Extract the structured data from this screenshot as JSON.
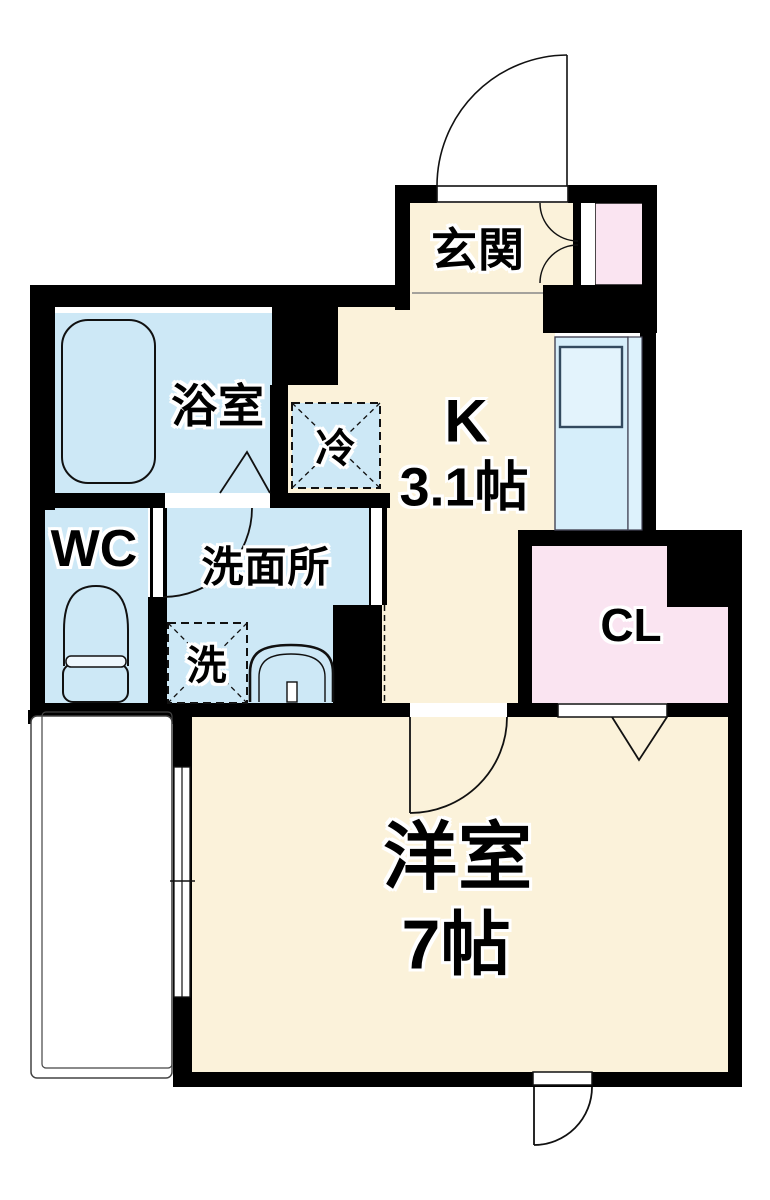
{
  "title": "1K apartment floor plan",
  "colors": {
    "wall": "#000000",
    "floor_cream": "#fbf2da",
    "wet_blue": "#cde8f6",
    "counter_blue": "#d6eefa",
    "counter_strip_blue": "#ddf2fc",
    "closet_pink": "#fae4f1",
    "line": "#111111"
  },
  "rooms": {
    "genkan": {
      "label": "玄関"
    },
    "bathroom": {
      "label": "浴室"
    },
    "toilet": {
      "label": "WC"
    },
    "washroom": {
      "label": "洗面所"
    },
    "kitchen": {
      "label": "K",
      "size": "3.1帖"
    },
    "closet": {
      "label": "CL"
    },
    "western_room": {
      "label": "洋室",
      "size": "7帖"
    },
    "refrigerator": {
      "label": "冷"
    },
    "washer": {
      "label": "洗"
    }
  },
  "fixtures": {
    "bathtub": "bathtub",
    "toilet_bowl": "toilet",
    "washbasin": "sink",
    "kitchen_counter": "kitchen counter with sink",
    "balcony": "balcony",
    "entry_door": "entry swing door",
    "window": "sliding window"
  }
}
